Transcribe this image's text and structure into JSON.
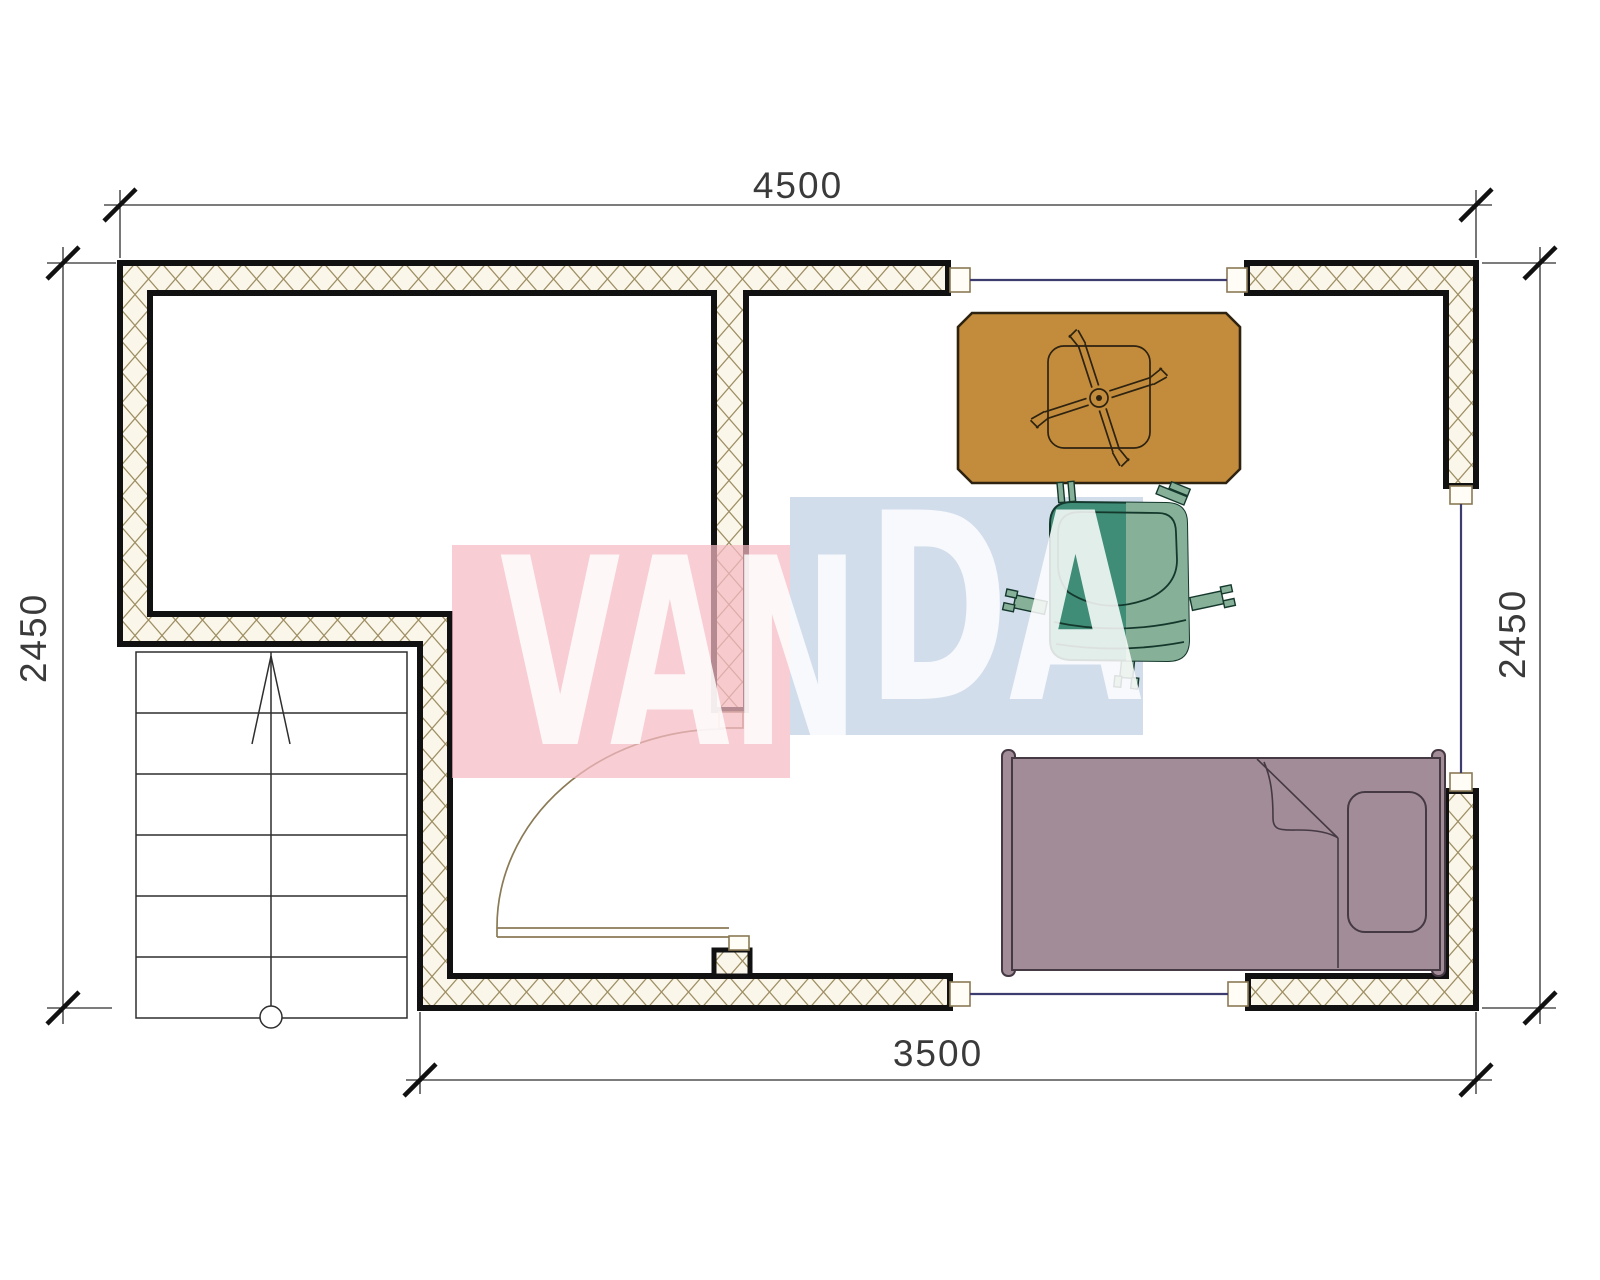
{
  "title": "floor-plan-drawing",
  "dimensions": {
    "top": "4500",
    "left": "2450",
    "right": "2450",
    "bottom": "3500"
  },
  "watermark": {
    "text_left": "VAN",
    "text_right": "DA",
    "pink": "#f5bac4",
    "blue": "#cdd9ea",
    "letter_color": "#ffffff"
  },
  "plan": {
    "colors": {
      "outline": "#111111",
      "line": "#2e2e2e",
      "dim_text": "#3a3a3a",
      "hatch": "#9e8f63",
      "wall_bg": "#fbf6ea",
      "window": "#3c3c6e",
      "door_trim": "#8a7a55",
      "cap_fill": "#fffdf6",
      "desk": "#c28c3c",
      "desk_outline": "#2e2210",
      "chair_dark": "#3f8d77",
      "chair_light": "#86b098",
      "chair_outline": "#15382d",
      "bed": "#a28c98",
      "bed_outline": "#453944"
    },
    "stairs": {
      "treads": 6
    },
    "rooms": {
      "window_count": 3,
      "door_count": 1
    }
  }
}
